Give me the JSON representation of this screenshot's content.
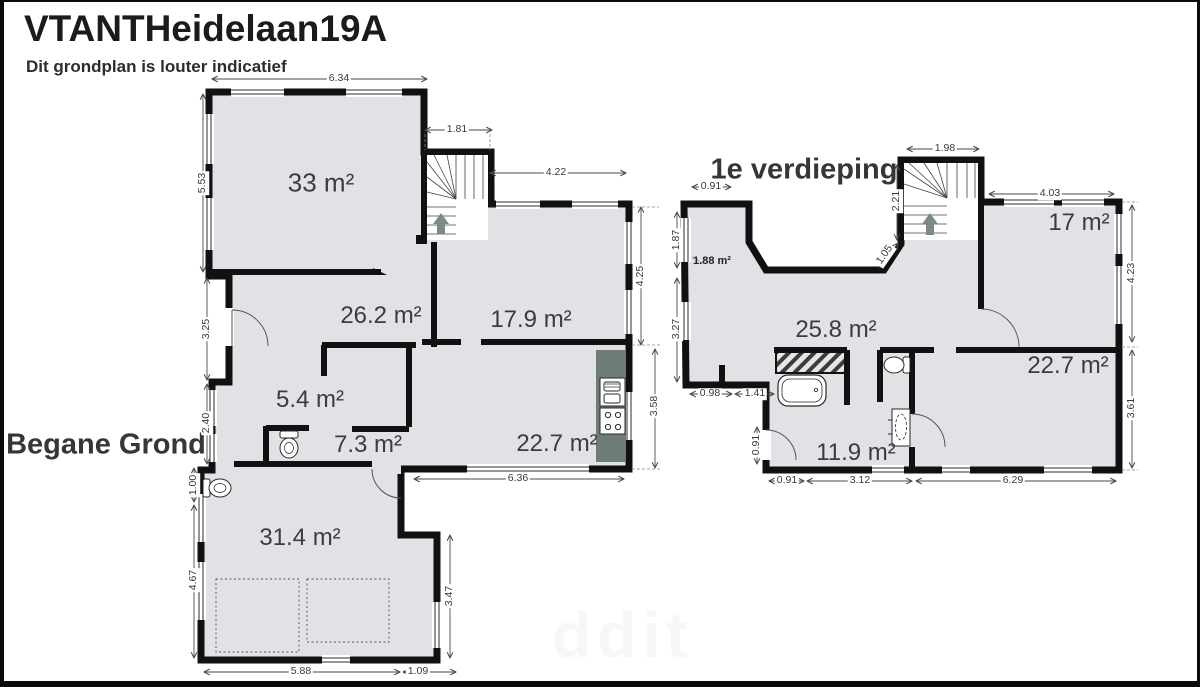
{
  "header": {
    "title": "VTANTHeidelaan19A",
    "subtitle": "Dit grondplan is louter indicatief"
  },
  "watermark": "ddit",
  "colors": {
    "floor_fill": "#e2e2e6",
    "wall": "#111111",
    "kitchen_counter": "#6e7c78",
    "stair_arrow": "#7c8b81",
    "dimension_text": "#383838"
  },
  "ground_floor": {
    "label": "Begane Grond",
    "rooms": {
      "room_33": "33 m²",
      "room_26_2": "26.2 m²",
      "room_17_9": "17.9 m²",
      "room_5_4": "5.4 m²",
      "room_7_3": "7.3 m²",
      "room_22_7": "22.7 m²",
      "room_31_4": "31.4 m²"
    },
    "dims": {
      "top_width": "6.34",
      "stair_width": "1.81",
      "top_right_width": "4.22",
      "left_height_upper": "5.53",
      "left_height_mid": "3.25",
      "left_height_lower": "2.40",
      "left_height_wc": "1.00",
      "left_height_bottom": "4.67",
      "right_height_upper": "4.25",
      "right_height_lower": "3.58",
      "bottom_width_kitchen": "6.36",
      "right_height_garage": "3.47",
      "bottom_width_garage": "5.88",
      "bottom_width_step": "1.09"
    }
  },
  "first_floor": {
    "label": "1e verdieping",
    "rooms": {
      "room_17": "17 m²",
      "room_25_8": "25.8 m²",
      "room_22_7": "22.7 m²",
      "room_11_9": "11.9 m²",
      "room_1_88": "1.88 m²"
    },
    "dims": {
      "top_left_width": "0.91",
      "stair_width": "1.98",
      "top_right_width": "4.03",
      "left_height_upper": "1.87",
      "left_height_lower": "3.27",
      "stair_height": "2.21",
      "diagonal": "1.05",
      "bottom_left_a": "0.98",
      "bottom_left_b": "1.41",
      "left_door_height": "0.91",
      "bottom_width_a": "0.91",
      "bottom_width_b": "3.12",
      "bottom_width_c": "6.29",
      "right_height_upper": "4.23",
      "right_height_lower": "3.61"
    }
  }
}
